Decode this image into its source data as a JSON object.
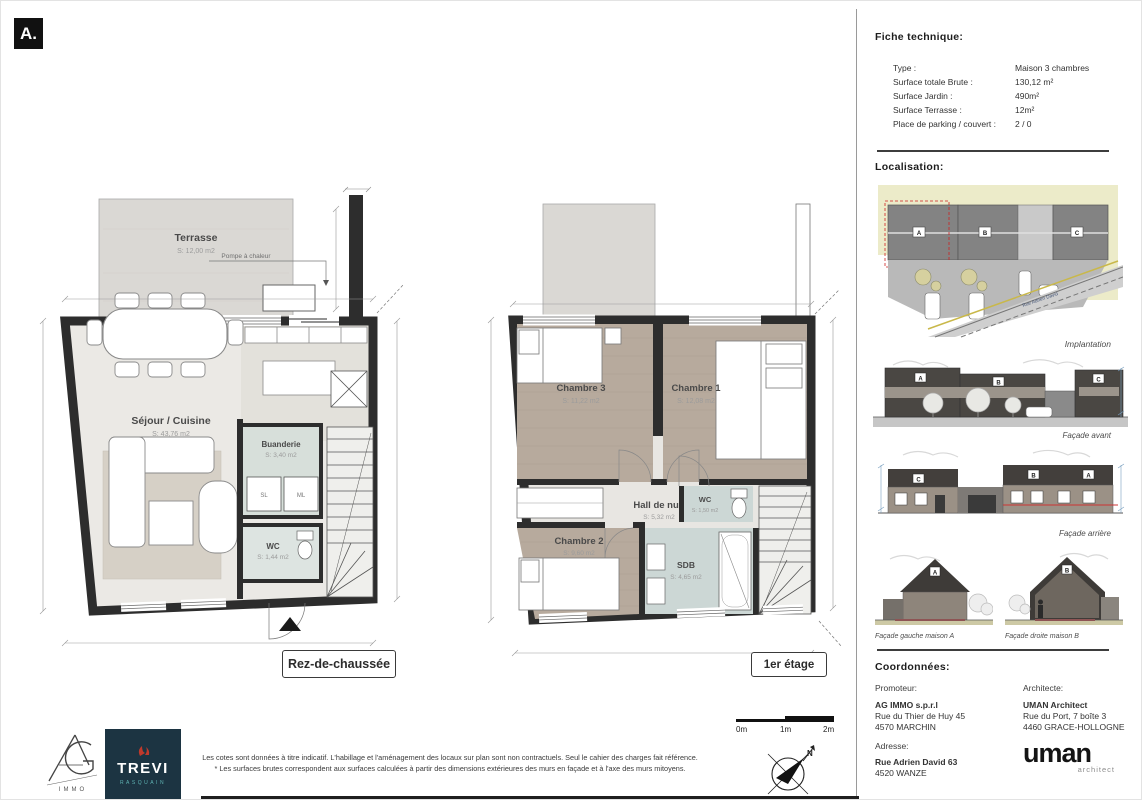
{
  "page": {
    "sheet_label": "A."
  },
  "plans": {
    "ground": {
      "title": "Rez-de-chaussée",
      "terrasse_name": "Terrasse",
      "terrasse_area": "S: 12,00 m2",
      "pompe_label": "Pompe à chaleur",
      "sejour_name": "Séjour / Cuisine",
      "sejour_area": "S: 43,76 m2",
      "buanderie_name": "Buanderie",
      "buanderie_area": "S: 3,40 m2",
      "wc_name": "WC",
      "wc_area": "S: 1,44 m2",
      "appliance_left": "SL",
      "appliance_right": "ML"
    },
    "first": {
      "title": "1er étage",
      "chambre3_name": "Chambre 3",
      "chambre3_area": "S: 11,22 m2",
      "chambre1_name": "Chambre 1",
      "chambre1_area": "S: 12,08 m2",
      "hall_name": "Hall de nuit",
      "hall_area": "S: 5,32 m2",
      "chambre2_name": "Chambre 2",
      "chambre2_area": "S: 9,60 m2",
      "sdb_name": "SDB",
      "sdb_area": "S: 4,65 m2",
      "wc_name": "WC",
      "wc_area": "S: 1,50 m2"
    }
  },
  "sidebar": {
    "fiche": {
      "title": "Fiche technique:",
      "rows": [
        {
          "label": "Type :",
          "value": "Maison 3 chambres"
        },
        {
          "label": "Surface totale Brute :",
          "value": "130,12 m²"
        },
        {
          "label": "Surface Jardin :",
          "value": "490m²"
        },
        {
          "label": "Surface Terrasse :",
          "value": "12m²"
        },
        {
          "label": "Place de parking / couvert :",
          "value": "2 / 0"
        }
      ]
    },
    "localisation": {
      "title": "Localisation:",
      "implantation_caption": "Implantation",
      "street_name": "Rue Adrien David",
      "unit_a": "A",
      "unit_b": "B",
      "unit_c": "C",
      "facade_avant_caption": "Façade avant",
      "facade_arriere_caption": "Façade arrière",
      "facade_gauche_caption": "Façade gauche maison A",
      "facade_droite_caption": "Façade droite maison B"
    },
    "coordonnees": {
      "title": "Coordonnées:",
      "promoteur_label": "Promoteur:",
      "promoteur_line1": "AG IMMO s.p.r.l",
      "promoteur_line2": "Rue du Thier de Huy 45",
      "promoteur_line3": "4570 MARCHIN",
      "architecte_label": "Architecte:",
      "architecte_line1": "UMAN Architect",
      "architecte_line2": "Rue du Port, 7 boîte 3",
      "architecte_line3": "4460 GRACE-HOLLOGNE",
      "adresse_label": "Adresse:",
      "adresse_line1": "Rue Adrien David 63",
      "adresse_line2": "4520 WANZE",
      "uman_logo_text": "uman",
      "uman_logo_sub": "architect"
    }
  },
  "footer": {
    "ag_logo_sub": "IMMO",
    "trevi_logo_text": "TREVI",
    "trevi_logo_sub": "RASQUAIN",
    "disclaimer_line1": "Les cotes sont données à titre indicatif. L'habillage et l'aménagement des locaux sur plan sont non contractuels. Seul le cahier des charges fait référence.",
    "disclaimer_line2": "* Les surfaces brutes correspondent aux surfaces calculées à partir des dimensions extérieures des murs en façade et à l'axe des murs mitoyens.",
    "scale_labels": [
      "0m",
      "1m",
      "2m"
    ],
    "north_label": "N"
  },
  "colors": {
    "wall": "#2d2d2d",
    "wood_floor": "#b7aa9d",
    "wet_room": "#ccd7d5",
    "laundry": "#d7dfda",
    "terrace": "#dad8d4",
    "accent_red": "#cc2222",
    "trevi_navy": "#1c3442",
    "trevi_teal": "#5fb3b3",
    "trevi_red": "#c0392b"
  }
}
